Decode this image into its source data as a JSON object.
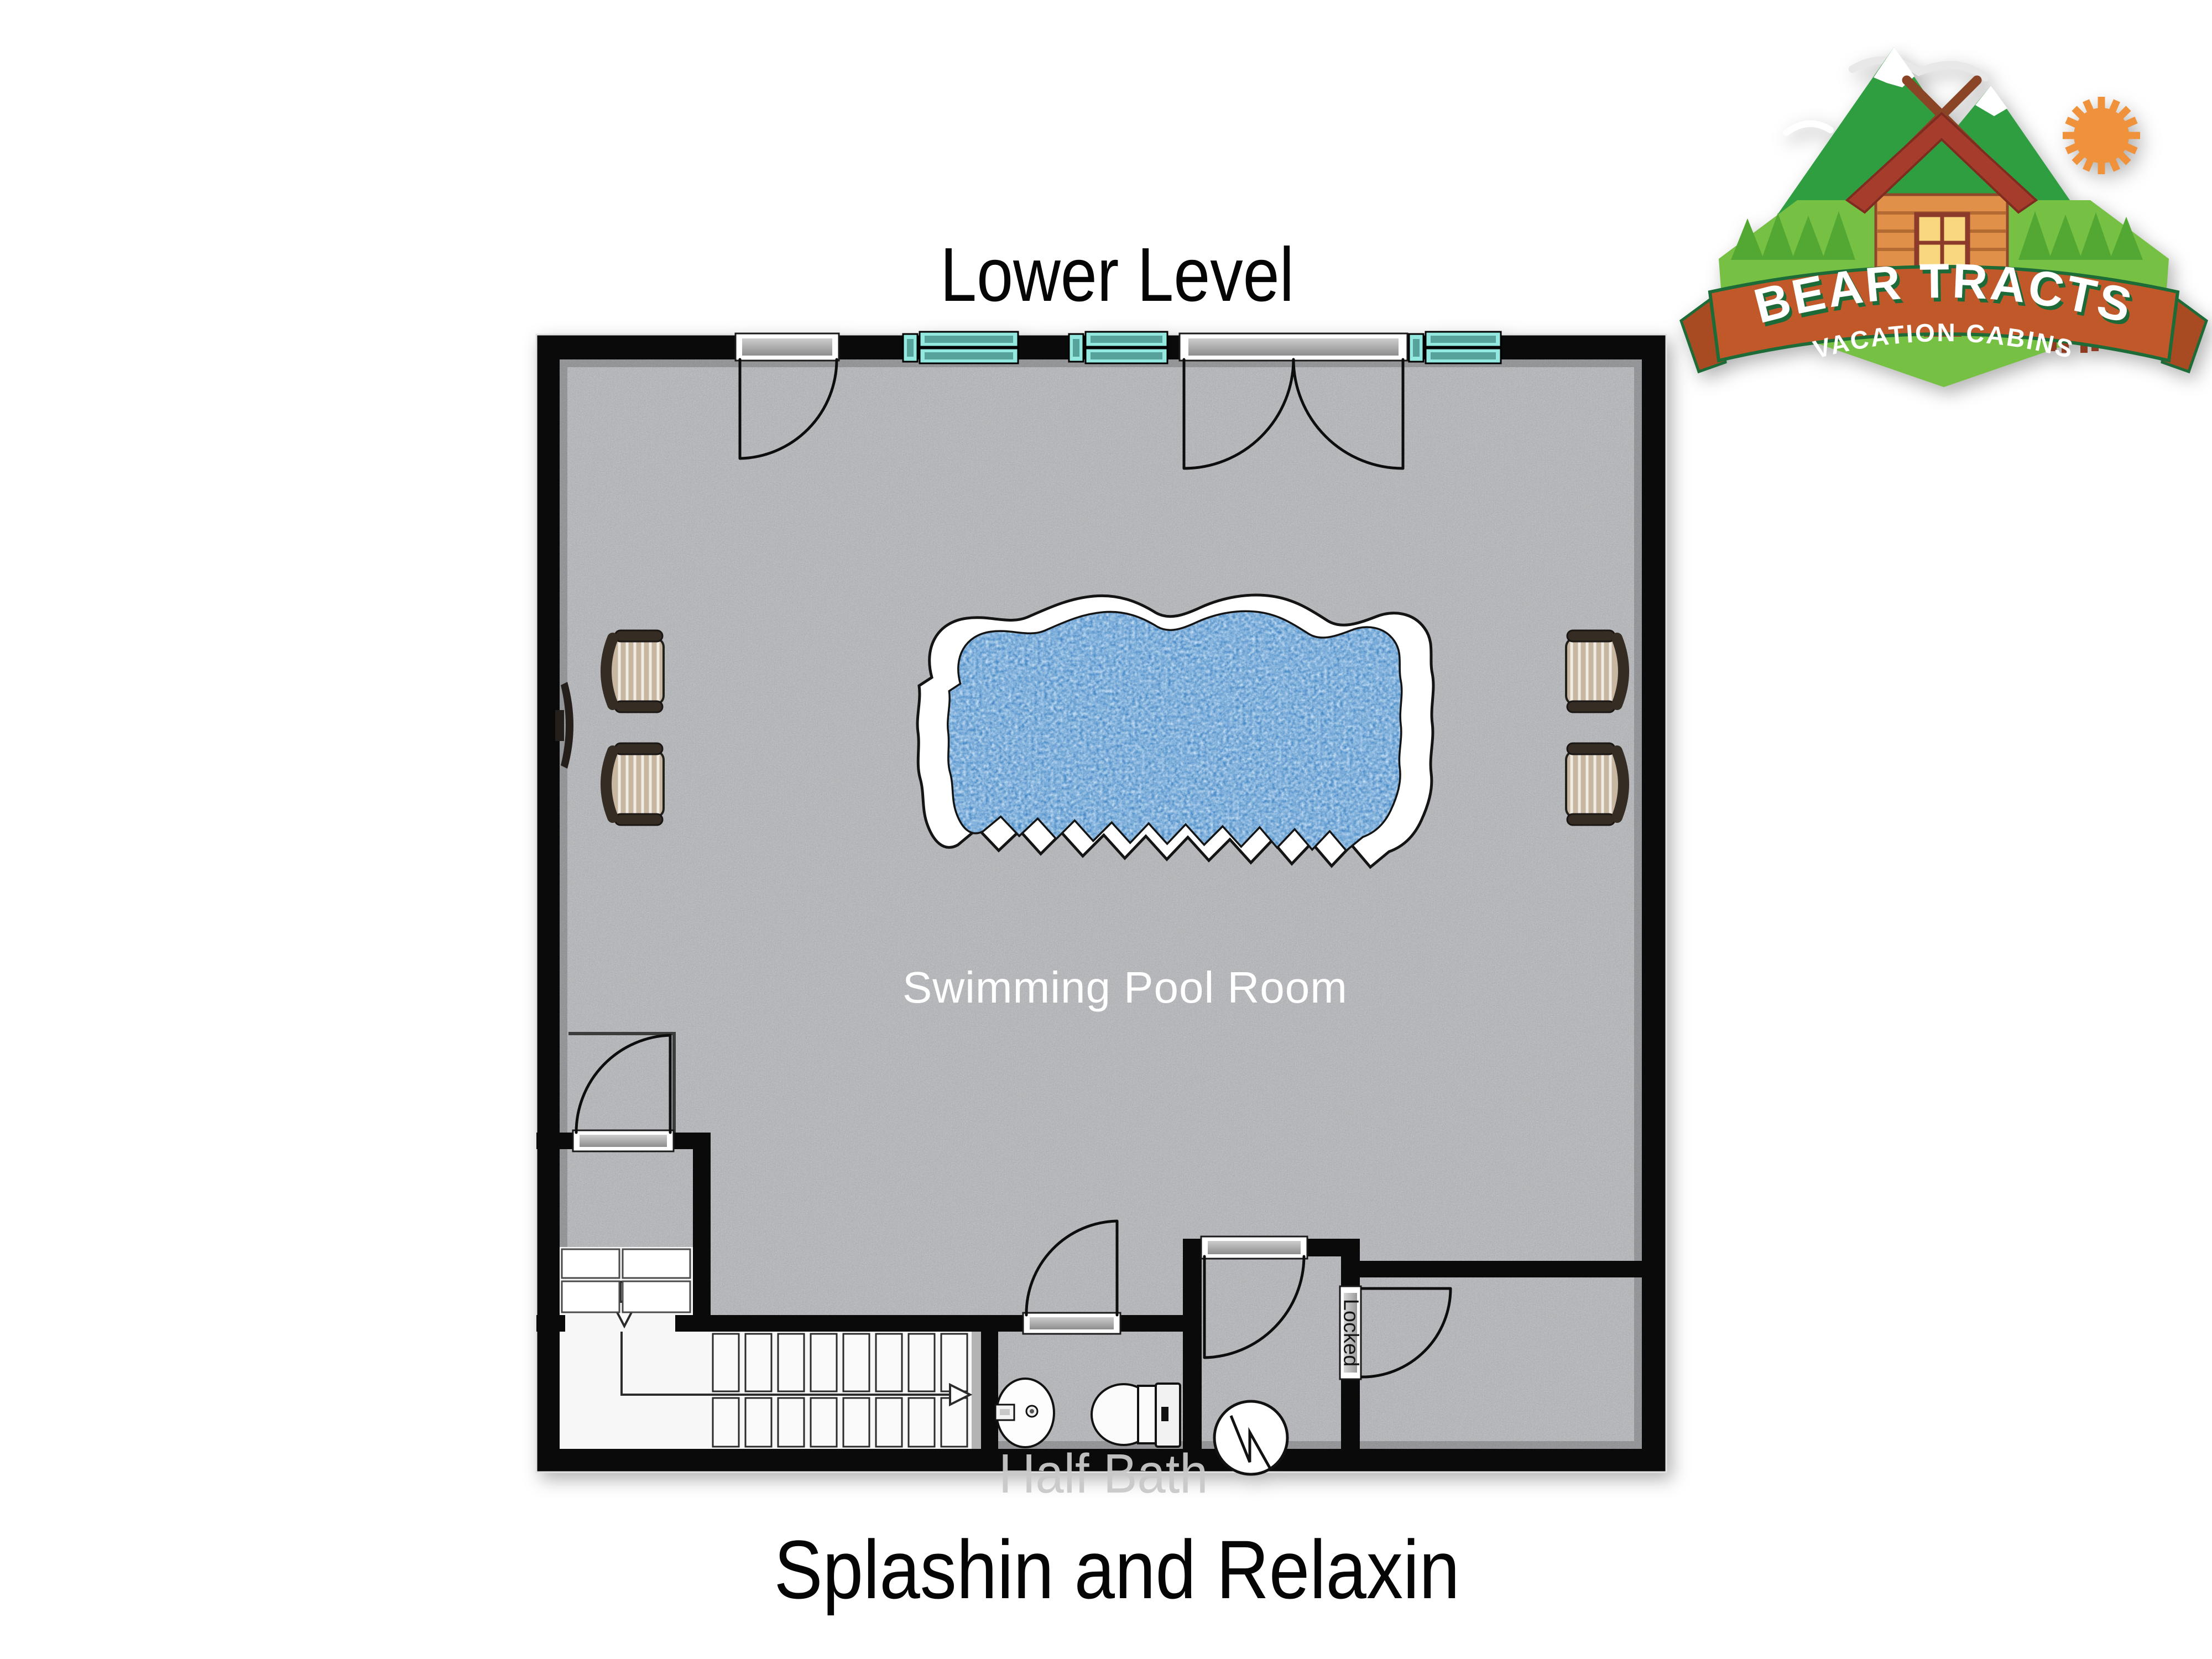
{
  "header": {
    "title": "Lower Level"
  },
  "footer": {
    "caption": "Splashin and Relaxin"
  },
  "logo": {
    "brand": "BEAR TRACTS",
    "tagline": "VACATION CABINS",
    "icons": [
      "mountains-icon",
      "sun-icon",
      "log-cabin-icon",
      "bear-icon",
      "paw-prints-icon",
      "banner-ribbon"
    ]
  },
  "plan": {
    "labels": {
      "pool_room": "Swimming Pool Room",
      "half_bath": "Half Bath",
      "locked_door": "Locked"
    },
    "windows_count": 3,
    "doors": [
      "single-entry-door-top",
      "double-french-door-top",
      "vestibule-door",
      "half-bath-door",
      "mechanical-room-door",
      "locked-door"
    ],
    "fixtures": [
      "free-form-swimming-pool",
      "lounge-chair x4",
      "wall-mounted-tv",
      "staircase-with-up-arrow",
      "closet-shelves",
      "down-arrow",
      "pedestal-sink",
      "toilet",
      "water-heater"
    ],
    "colors": {
      "wall": "#0a0a0a",
      "floor_concrete": "#abadb0",
      "pool_water": "#4a8ac9",
      "pool_deck": "#ffffff",
      "window_teal_light": "#93e8e0",
      "window_teal_dark": "#57a39c",
      "door_slab_gray": "#b4b4b4",
      "chair_tan": "#c7b7a1",
      "chair_frame_brown": "#352c24",
      "stair_white": "#fafafa",
      "logo_mountain_green": "#2f9e41",
      "logo_field_green": "#76c043",
      "banner_orange": "#c1582a",
      "banner_edge_green": "#1d6b37",
      "bear_brown": "#8e3b21"
    }
  }
}
